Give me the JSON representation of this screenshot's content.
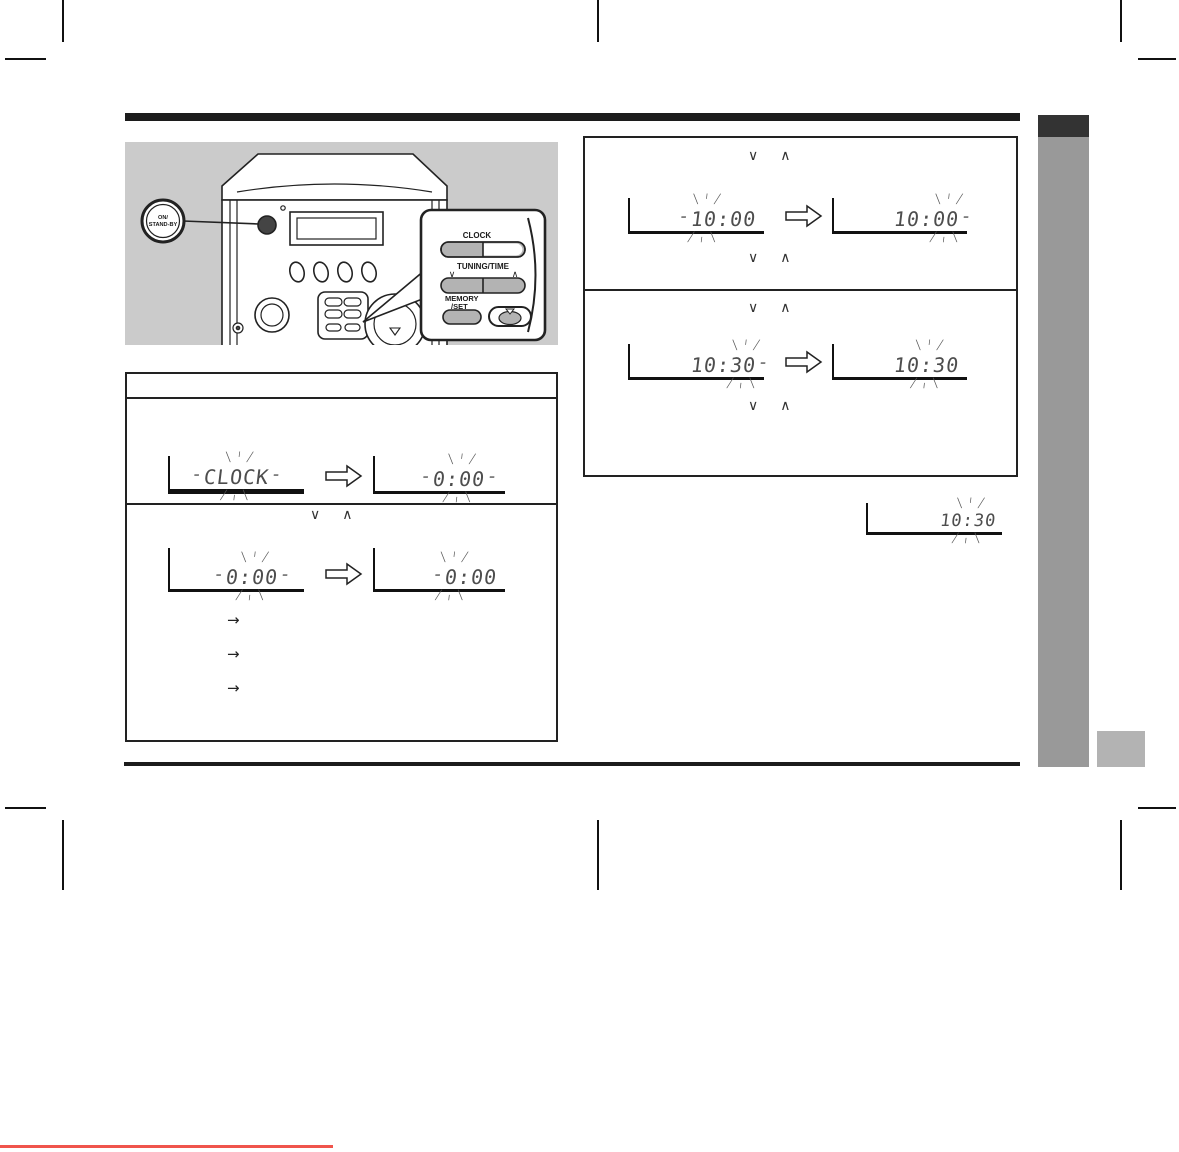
{
  "glyphs": {
    "down": "∨",
    "up": "∧",
    "bullet_arrow": "→"
  },
  "device": {
    "power_label_line1": "ON/",
    "power_label_line2": "STAND-BY"
  },
  "remote": {
    "clock_label": "CLOCK",
    "tuning_time_label": "TUNING/TIME",
    "memory_label": "MEMORY",
    "set_label": "/SET"
  },
  "steps_left": {
    "pair1": {
      "left": {
        "pre": "",
        "blink": "CLOCK",
        "post": ""
      },
      "right": {
        "pre": "",
        "blink": "0:00",
        "post": ""
      }
    },
    "pair2": {
      "left": {
        "pre": "",
        "blink": "0:00",
        "post": ""
      },
      "right": {
        "pre": "",
        "blink": "0",
        "post": ":00"
      }
    },
    "bullets": {
      "b1": "→",
      "b2": "→",
      "b3": "→"
    }
  },
  "steps_right": {
    "box1": {
      "left": {
        "pre": "",
        "blink": "10",
        "post": ":00"
      },
      "right": {
        "pre": "10:",
        "blink": "00",
        "post": ""
      }
    },
    "box2": {
      "left": {
        "pre": "10:",
        "blink": "30",
        "post": ""
      },
      "right": {
        "pre": "10",
        "blink": ":",
        "post": "30"
      }
    },
    "result": {
      "pre": "10",
      "blink": ":",
      "post": "30"
    }
  },
  "colors": {
    "accent_red": "#f0544c",
    "sidebar_gray": "#999999",
    "tab_gray": "#b3b3b3",
    "illustration_bg": "#cbcbcb",
    "ink": "#1a1a1a"
  }
}
